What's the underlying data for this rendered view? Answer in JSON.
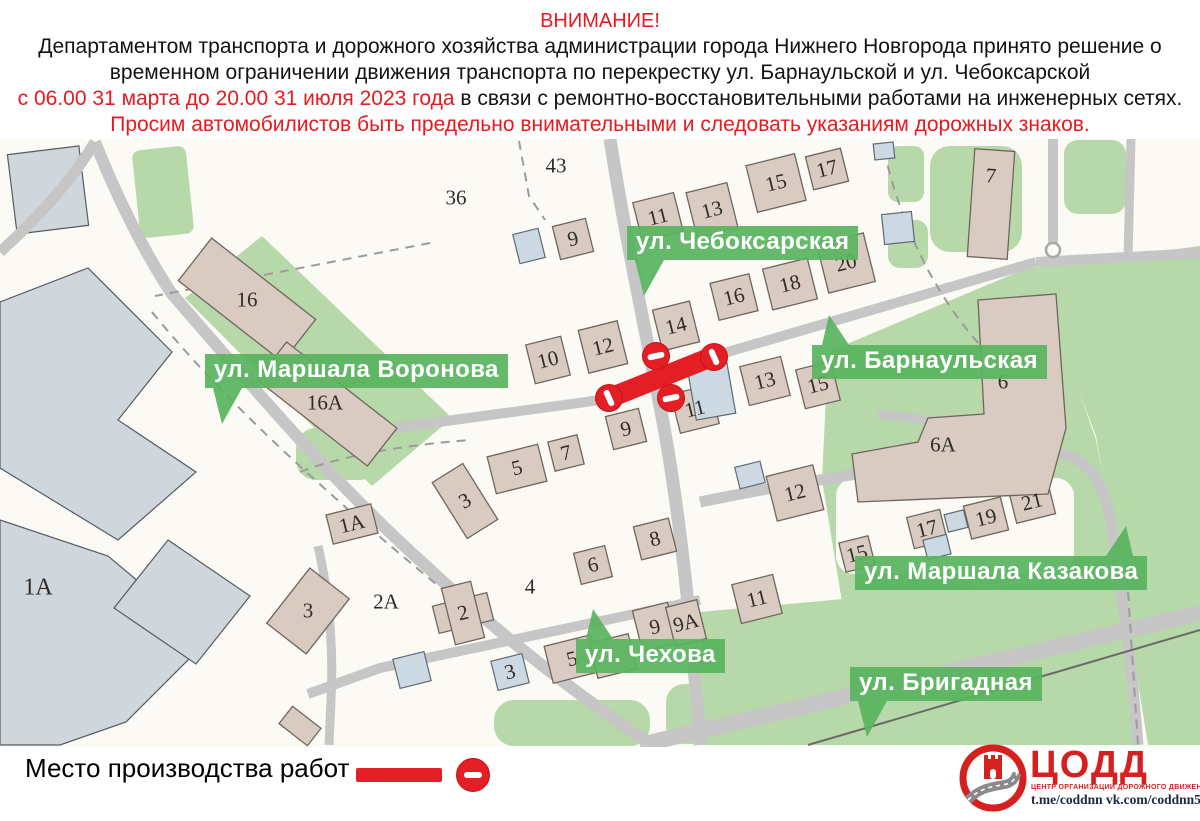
{
  "header": {
    "lines": [
      {
        "parts": [
          {
            "t": "ВНИМАНИЕ!",
            "c": "red"
          }
        ]
      },
      {
        "parts": [
          {
            "t": "Департаментом транспорта и дорожного хозяйства администрации города Нижнего Новгорода принято решение о",
            "c": "black"
          }
        ]
      },
      {
        "parts": [
          {
            "t": "временном ограничении движения транспорта по перекрестку ул. Барнаульской и ул. Чебоксарской",
            "c": "black"
          }
        ]
      },
      {
        "parts": [
          {
            "t": "с 06.00 31 марта до 20.00 31 июля 2023 года",
            "c": "red"
          },
          {
            "t": " в связи с ремонтно-восстановительными работами на инженерных сетях.",
            "c": "black"
          }
        ]
      },
      {
        "parts": [
          {
            "t": "Просим автомобилистов быть предельно внимательными и следовать указаниям дорожных знаков.",
            "c": "red"
          }
        ]
      }
    ]
  },
  "map": {
    "street_labels": [
      {
        "id": "cheboksarskaya",
        "text": "ул. Чебоксарская",
        "x": 627,
        "y": 226,
        "ptr": "down-left"
      },
      {
        "id": "voronova",
        "text": "ул. Маршала Воронова",
        "x": 205,
        "y": 354,
        "ptr": "down-left"
      },
      {
        "id": "barnaulskaya",
        "text": "ул. Барнаульская",
        "x": 812,
        "y": 345,
        "ptr": "up-left"
      },
      {
        "id": "kazakova",
        "text": "ул. Маршала Казакова",
        "x": 855,
        "y": 556,
        "ptr": "up-right"
      },
      {
        "id": "chekhova",
        "text": "ул. Чехова",
        "x": 576,
        "y": 639,
        "ptr": "up-left"
      },
      {
        "id": "brigadnaya",
        "text": "ул. Бригадная",
        "x": 850,
        "y": 667,
        "ptr": "down-left"
      }
    ],
    "house_numbers": [
      {
        "t": "43",
        "x": 556,
        "y": 166,
        "r": 0
      },
      {
        "t": "36",
        "x": 456,
        "y": 198,
        "r": 0
      },
      {
        "t": "9",
        "x": 573,
        "y": 239,
        "r": -14
      },
      {
        "t": "11",
        "x": 658,
        "y": 217,
        "r": -14
      },
      {
        "t": "13",
        "x": 712,
        "y": 210,
        "r": -14
      },
      {
        "t": "15",
        "x": 776,
        "y": 183,
        "r": -14
      },
      {
        "t": "17",
        "x": 827,
        "y": 169,
        "r": -14
      },
      {
        "t": "7",
        "x": 991,
        "y": 176,
        "r": 4
      },
      {
        "t": "20",
        "x": 846,
        "y": 263,
        "r": -14
      },
      {
        "t": "18",
        "x": 790,
        "y": 284,
        "r": -14
      },
      {
        "t": "16",
        "x": 734,
        "y": 297,
        "r": -14
      },
      {
        "t": "14",
        "x": 676,
        "y": 326,
        "r": -14
      },
      {
        "t": "12",
        "x": 603,
        "y": 347,
        "r": -14
      },
      {
        "t": "10",
        "x": 548,
        "y": 360,
        "r": -14
      },
      {
        "t": "16",
        "x": 247,
        "y": 300,
        "r": 0
      },
      {
        "t": "16А",
        "x": 325,
        "y": 403,
        "r": 0
      },
      {
        "t": "1А",
        "x": 38,
        "y": 588,
        "r": 0,
        "s": 24
      },
      {
        "t": "3",
        "x": 308,
        "y": 611,
        "r": 0
      },
      {
        "t": "1А",
        "x": 352,
        "y": 524,
        "r": -14
      },
      {
        "t": "2А",
        "x": 386,
        "y": 602,
        "r": 0
      },
      {
        "t": "2",
        "x": 463,
        "y": 613,
        "r": -14
      },
      {
        "t": "3",
        "x": 465,
        "y": 501,
        "r": -30
      },
      {
        "t": "5",
        "x": 517,
        "y": 468,
        "r": -14
      },
      {
        "t": "7",
        "x": 566,
        "y": 453,
        "r": -14
      },
      {
        "t": "9",
        "x": 626,
        "y": 429,
        "r": -14
      },
      {
        "t": "11",
        "x": 695,
        "y": 409,
        "r": -14
      },
      {
        "t": "13",
        "x": 765,
        "y": 381,
        "r": -14
      },
      {
        "t": "15",
        "x": 818,
        "y": 385,
        "r": -14
      },
      {
        "t": "4",
        "x": 530,
        "y": 587,
        "r": 0
      },
      {
        "t": "6",
        "x": 593,
        "y": 565,
        "r": -14
      },
      {
        "t": "8",
        "x": 655,
        "y": 539,
        "r": -14
      },
      {
        "t": "12",
        "x": 795,
        "y": 493,
        "r": -14
      },
      {
        "t": "6А",
        "x": 943,
        "y": 445,
        "r": 0
      },
      {
        "t": "6",
        "x": 1003,
        "y": 382,
        "r": 0
      },
      {
        "t": "15",
        "x": 857,
        "y": 554,
        "r": -14
      },
      {
        "t": "17",
        "x": 927,
        "y": 529,
        "r": -14
      },
      {
        "t": "19",
        "x": 986,
        "y": 518,
        "r": -14
      },
      {
        "t": "21",
        "x": 1032,
        "y": 502,
        "r": -14
      },
      {
        "t": "11",
        "x": 757,
        "y": 599,
        "r": -14
      },
      {
        "t": "9",
        "x": 655,
        "y": 627,
        "r": -14
      },
      {
        "t": "9А",
        "x": 686,
        "y": 623,
        "r": -14
      },
      {
        "t": "5",
        "x": 572,
        "y": 659,
        "r": -14
      },
      {
        "t": "3",
        "x": 510,
        "y": 672,
        "r": -14
      }
    ],
    "closure": {
      "description": "перекрытие перекрестка ул. Барнаульской и ул. Чебоксарской",
      "sign": "no-entry"
    }
  },
  "legend": {
    "label": "Место производства работ -"
  },
  "logo": {
    "name": "ЦОДД",
    "tagline": "ЦЕНТР ОРГАНИЗАЦИИ ДОРОЖНОГО ДВИЖЕНИЯ",
    "links": "t.me/coddnn vk.com/coddnn52"
  },
  "colors": {
    "text_red": "#e8191f",
    "closure_red": "#e31e24",
    "badge_green": "#58b45f",
    "logo_red": "#d6201f",
    "map_ground": "#fbfaf5",
    "building_tan": "#d9cbc2",
    "building_blue": "#ccd9e2",
    "green_area": "#b7d9a9",
    "road_gray": "#c6c6c6"
  }
}
